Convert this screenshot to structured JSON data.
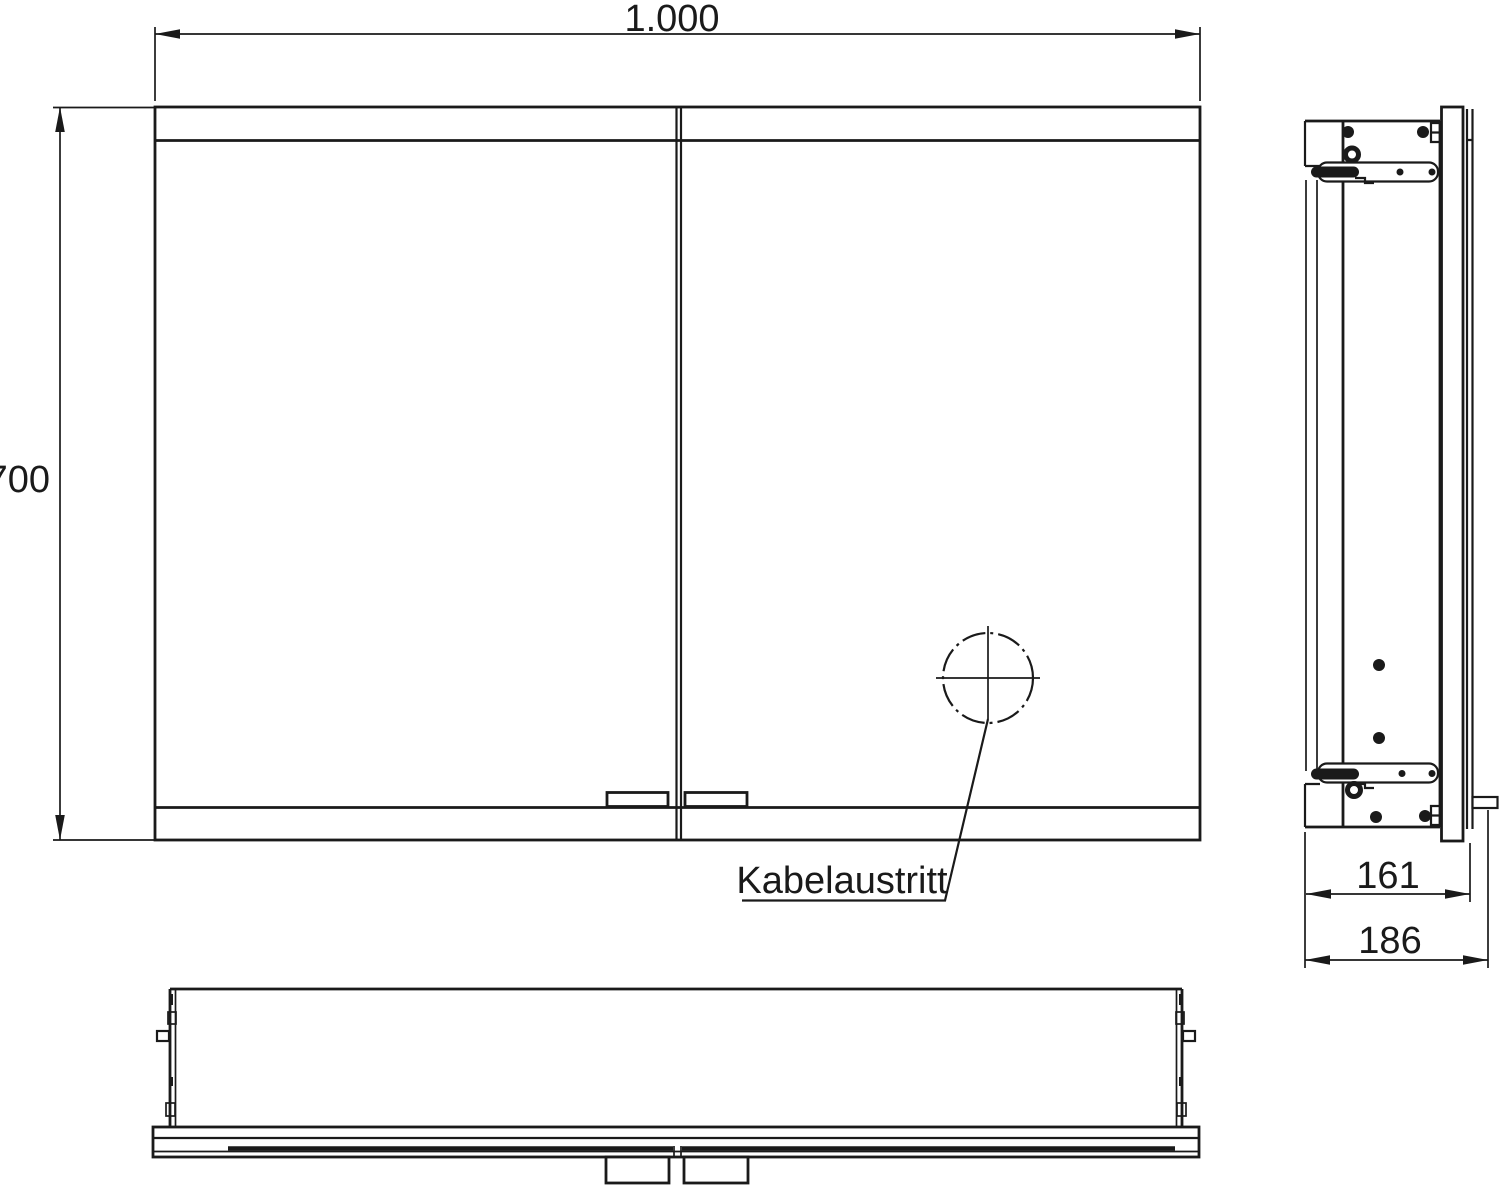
{
  "colors": {
    "line": "#1a1a1a",
    "background": "#ffffff"
  },
  "front_view": {
    "width_label": "1.000",
    "height_label": "700",
    "cable_outlet_label": "Kabelaustritt"
  },
  "side_view": {
    "depth_label": "161",
    "overall_depth_label": "186"
  }
}
